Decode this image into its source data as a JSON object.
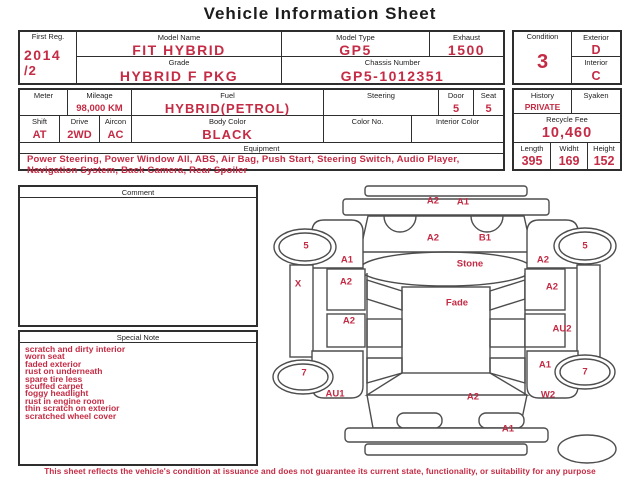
{
  "title": "Vehicle Information Sheet",
  "colors": {
    "accent_red": "#c42b44",
    "text_black": "#1c1c1c",
    "border": "#2e2e2e"
  },
  "top_table": {
    "first_reg": {
      "label": "First Reg.",
      "value_line1": "2014",
      "value_line2": "/2"
    },
    "model_name": {
      "label": "Model Name",
      "value": "FIT HYBRID"
    },
    "grade": {
      "label": "Grade",
      "value": "HYBRID F  PKG"
    },
    "model_type": {
      "label": "Model Type",
      "value": "GP5"
    },
    "exhaust": {
      "label": "Exhaust",
      "value": "1500"
    },
    "chassis_number": {
      "label": "Chassis Number",
      "value": "GP5-1012351"
    }
  },
  "condition_box": {
    "condition": {
      "label": "Condition",
      "value": "3"
    },
    "exterior": {
      "label": "Exterior",
      "value": "D"
    },
    "interior": {
      "label": "Interior",
      "value": "C"
    }
  },
  "spec_table": {
    "meter": {
      "label": "Meter",
      "value": ""
    },
    "mileage": {
      "label": "Mileage",
      "value": "98,000 KM"
    },
    "fuel": {
      "label": "Fuel",
      "value": "HYBRID(PETROL)"
    },
    "steering": {
      "label": "Steering",
      "value": ""
    },
    "door": {
      "label": "Door",
      "value": "5"
    },
    "seat": {
      "label": "Seat",
      "value": "5"
    },
    "shift": {
      "label": "Shift",
      "value": "AT"
    },
    "drive": {
      "label": "Drive",
      "value": "2WD"
    },
    "aircon": {
      "label": "Aircon",
      "value": "AC"
    },
    "body_color": {
      "label": "Body Color",
      "value": "BLACK"
    },
    "color_no": {
      "label": "Color No.",
      "value": ""
    },
    "interior_color": {
      "label": "Interior Color",
      "value": ""
    },
    "equipment": {
      "label": "Equipment",
      "value": "Power Steering, Power Window  All, ABS, Air Bag, Push Start, Steering Switch, Audio Player, Navigation System, Back Camera, Rear Spoiler"
    }
  },
  "right_box": {
    "history": {
      "label": "History",
      "value": "PRIVATE"
    },
    "syaken": {
      "label": "Syaken",
      "value": ""
    },
    "recycle_fee": {
      "label": "Recycle Fee",
      "value": "10,460"
    },
    "length": {
      "label": "Length",
      "value": "395"
    },
    "width": {
      "label": "Widht",
      "value": "169"
    },
    "height": {
      "label": "Height",
      "value": "152"
    }
  },
  "comment": {
    "label": "Comment",
    "value": ""
  },
  "special_note": {
    "label": "Special Note",
    "items": [
      "scratch and dirty interior",
      "worn seat",
      "faded exterior",
      "rust on underneath",
      "spare tire less",
      "scuffed carpet",
      "foggy headlight",
      "rust in engine room",
      "thin scratch on exterior",
      "scratched wheel cover"
    ]
  },
  "diagram": {
    "markers": [
      {
        "text": "A2",
        "x": 163,
        "y": 18
      },
      {
        "text": "A1",
        "x": 193,
        "y": 19
      },
      {
        "text": "A2",
        "x": 163,
        "y": 55
      },
      {
        "text": "B1",
        "x": 215,
        "y": 55
      },
      {
        "text": "Stone",
        "x": 200,
        "y": 81
      },
      {
        "text": "Fade",
        "x": 187,
        "y": 120
      },
      {
        "text": "5",
        "x": 36,
        "y": 63
      },
      {
        "text": "5",
        "x": 315,
        "y": 63
      },
      {
        "text": "A1",
        "x": 77,
        "y": 77
      },
      {
        "text": "A2",
        "x": 273,
        "y": 77
      },
      {
        "text": "X",
        "x": 28,
        "y": 101
      },
      {
        "text": "A2",
        "x": 76,
        "y": 99
      },
      {
        "text": "A2",
        "x": 282,
        "y": 104
      },
      {
        "text": "A2",
        "x": 79,
        "y": 138
      },
      {
        "text": "AU2",
        "x": 292,
        "y": 146
      },
      {
        "text": "A1",
        "x": 275,
        "y": 182
      },
      {
        "text": "7",
        "x": 34,
        "y": 190
      },
      {
        "text": "7",
        "x": 315,
        "y": 189
      },
      {
        "text": "AU1",
        "x": 65,
        "y": 211
      },
      {
        "text": "A2",
        "x": 203,
        "y": 214
      },
      {
        "text": "W2",
        "x": 278,
        "y": 212
      },
      {
        "text": "A1",
        "x": 238,
        "y": 246
      }
    ]
  },
  "footer": "This sheet reflects the vehicle's condition at issuance and does not guarantee its current state, functionality, or suitability for any purpose"
}
